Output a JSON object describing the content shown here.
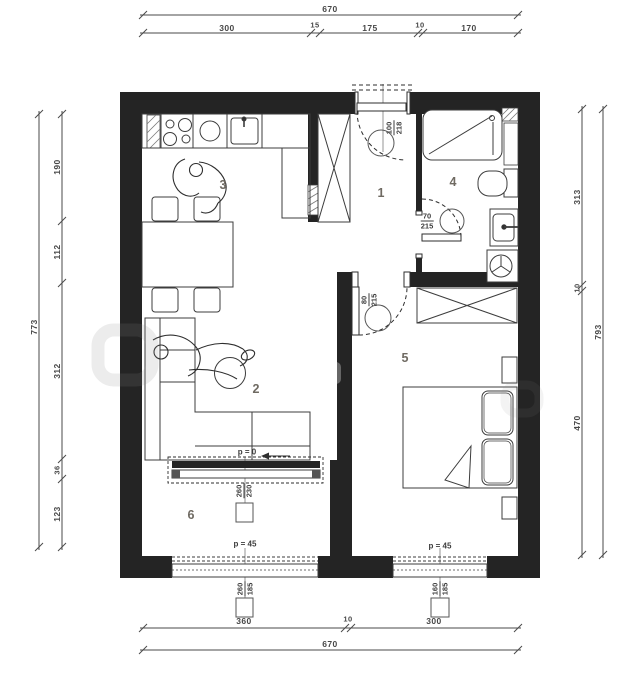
{
  "dims": {
    "top": {
      "total": "670",
      "segs": [
        "300",
        "15",
        "175",
        "10",
        "170"
      ]
    },
    "left": {
      "total": "773",
      "segs": [
        "190",
        "112",
        "312",
        "36",
        "123"
      ]
    },
    "right": {
      "total": "793",
      "segs": [
        "313",
        "10",
        "470"
      ]
    },
    "bottom": {
      "total": "670",
      "segs": [
        "360",
        "10",
        "300"
      ]
    }
  },
  "rooms": {
    "hall": "1",
    "living": "2",
    "kitchen": "3",
    "bath": "4",
    "bedroom": "5",
    "balcony": "6"
  },
  "openings": {
    "entry_door": {
      "w": "100",
      "h": "218"
    },
    "bath_door": {
      "w": "70",
      "h": "215"
    },
    "bedroom_door": {
      "w": "80",
      "h": "215"
    },
    "balcony_door": {
      "w": "260",
      "h": "230",
      "sill": "p = 0"
    },
    "balcony_window": {
      "w": "260",
      "h": "185",
      "sill": "p = 45"
    },
    "bedroom_window": {
      "w": "160",
      "h": "185",
      "sill": "p = 45"
    }
  },
  "colors": {
    "wall": "#242424",
    "line": "#3c3c3c",
    "dim_text": "#474747",
    "room_text": "#6f6a62"
  }
}
